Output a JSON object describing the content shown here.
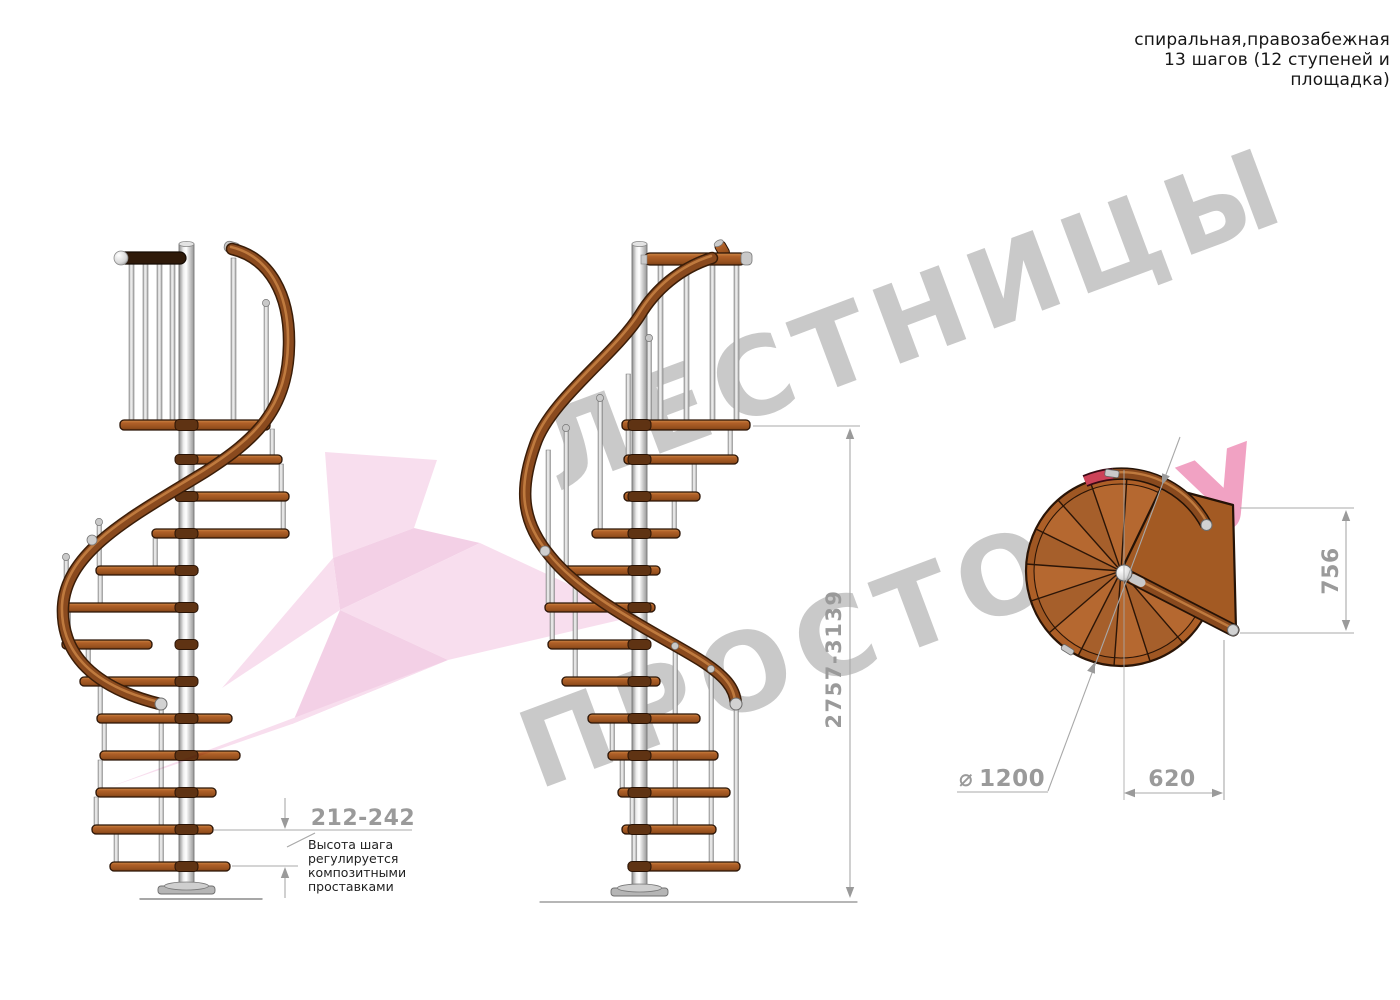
{
  "header": {
    "lines": [
      "спиральная,правозабежная",
      "13 шагов (12 ступеней и",
      "площадка)"
    ]
  },
  "watermark": {
    "word1": "ЛЕСТНИЦЫ",
    "word2": "ПРОСТО",
    "word2_suffix": ".РУ",
    "gray": "#c9c9c9",
    "pink": "#f1a2c3"
  },
  "dimensions": {
    "step_height": {
      "value": "212-242",
      "note_lines": [
        "Высота шага",
        "регулируется",
        "композитными",
        "проставками"
      ]
    },
    "total_height": {
      "value": "2757-3139"
    },
    "platform_depth": {
      "value": "756"
    },
    "platform_width": {
      "value": "620"
    },
    "diameter": {
      "symbol": "⌀",
      "value": "1200"
    }
  },
  "colors": {
    "wood": "#a85c24",
    "wood_dark": "#7c3f15",
    "handrail": "#8a4a1e",
    "top_rail_dark": "#2f1a0a",
    "metal": "#d6d6d6",
    "dimension_gray": "#9a9a9a",
    "red_accent": "#cd4258",
    "arrow_pink_light": "#f3c3e0",
    "arrow_pink_mid": "#eaaad2"
  }
}
